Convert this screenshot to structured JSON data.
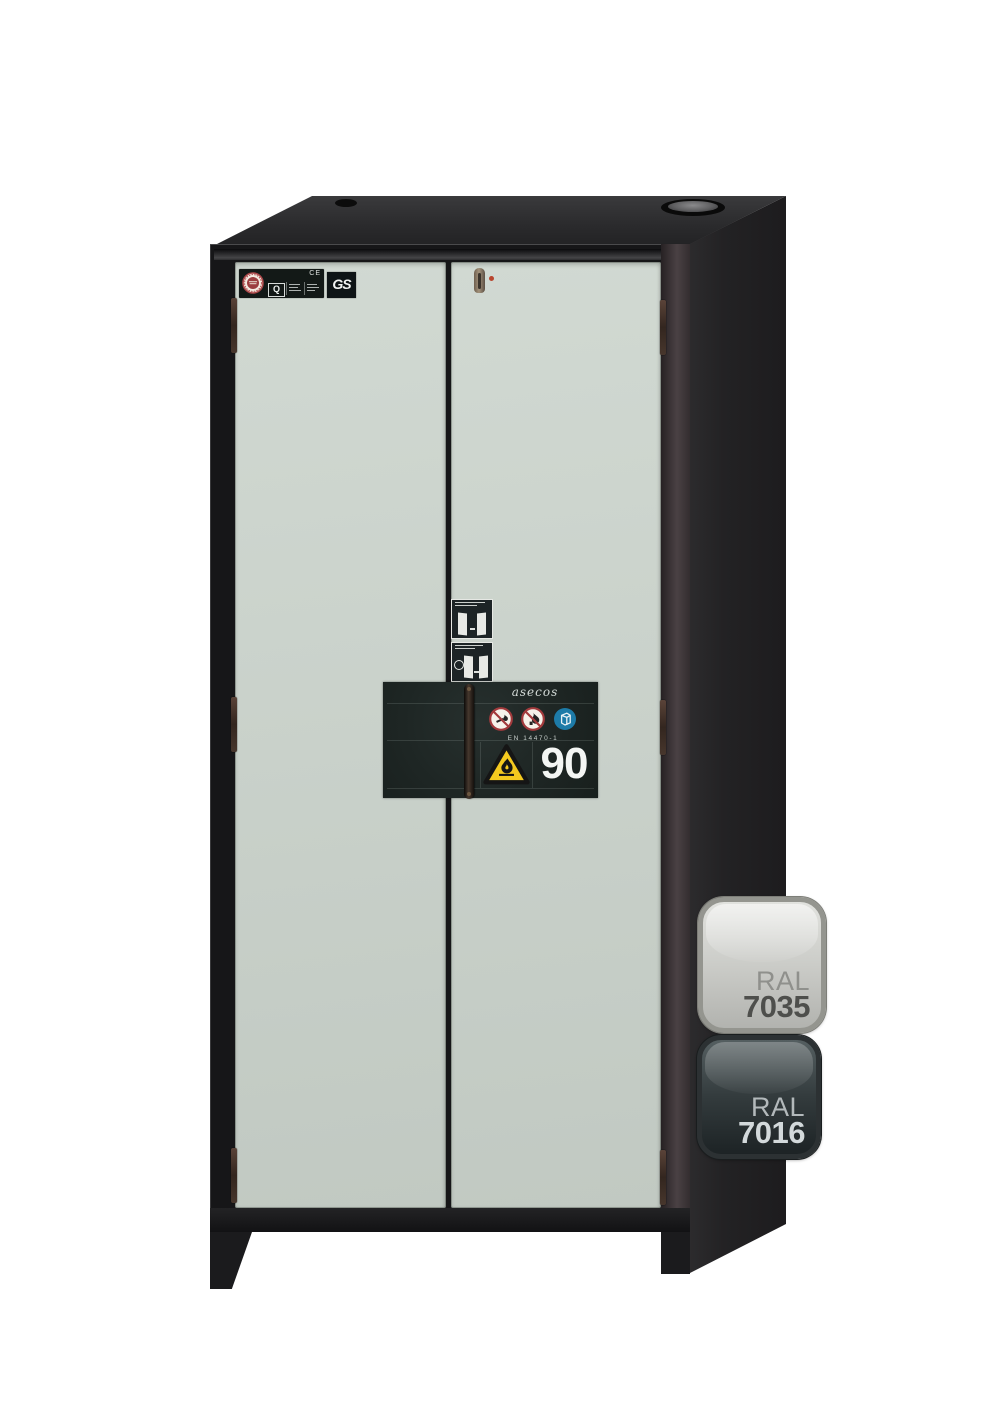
{
  "cabinet": {
    "certifications": {
      "quality_mark": "Q",
      "ce_mark": "CE",
      "gs_mark": "GS"
    },
    "type_plate": {
      "brand": "asecos",
      "standard": "EN 14470-1",
      "fire_resistance": "90"
    },
    "colors": {
      "door_front": "#c9d1ca",
      "body": "#232224",
      "type_plate_bg": "#1e2624",
      "warning_yellow": "#f4c91f",
      "mandatory_blue": "#1d7ba8",
      "prohibition_red": "#a23a3c"
    }
  },
  "color_swatches": [
    {
      "series": "RAL",
      "code": "7035",
      "color": "#c9cac6"
    },
    {
      "series": "RAL",
      "code": "7016",
      "color": "#383e40"
    }
  ]
}
